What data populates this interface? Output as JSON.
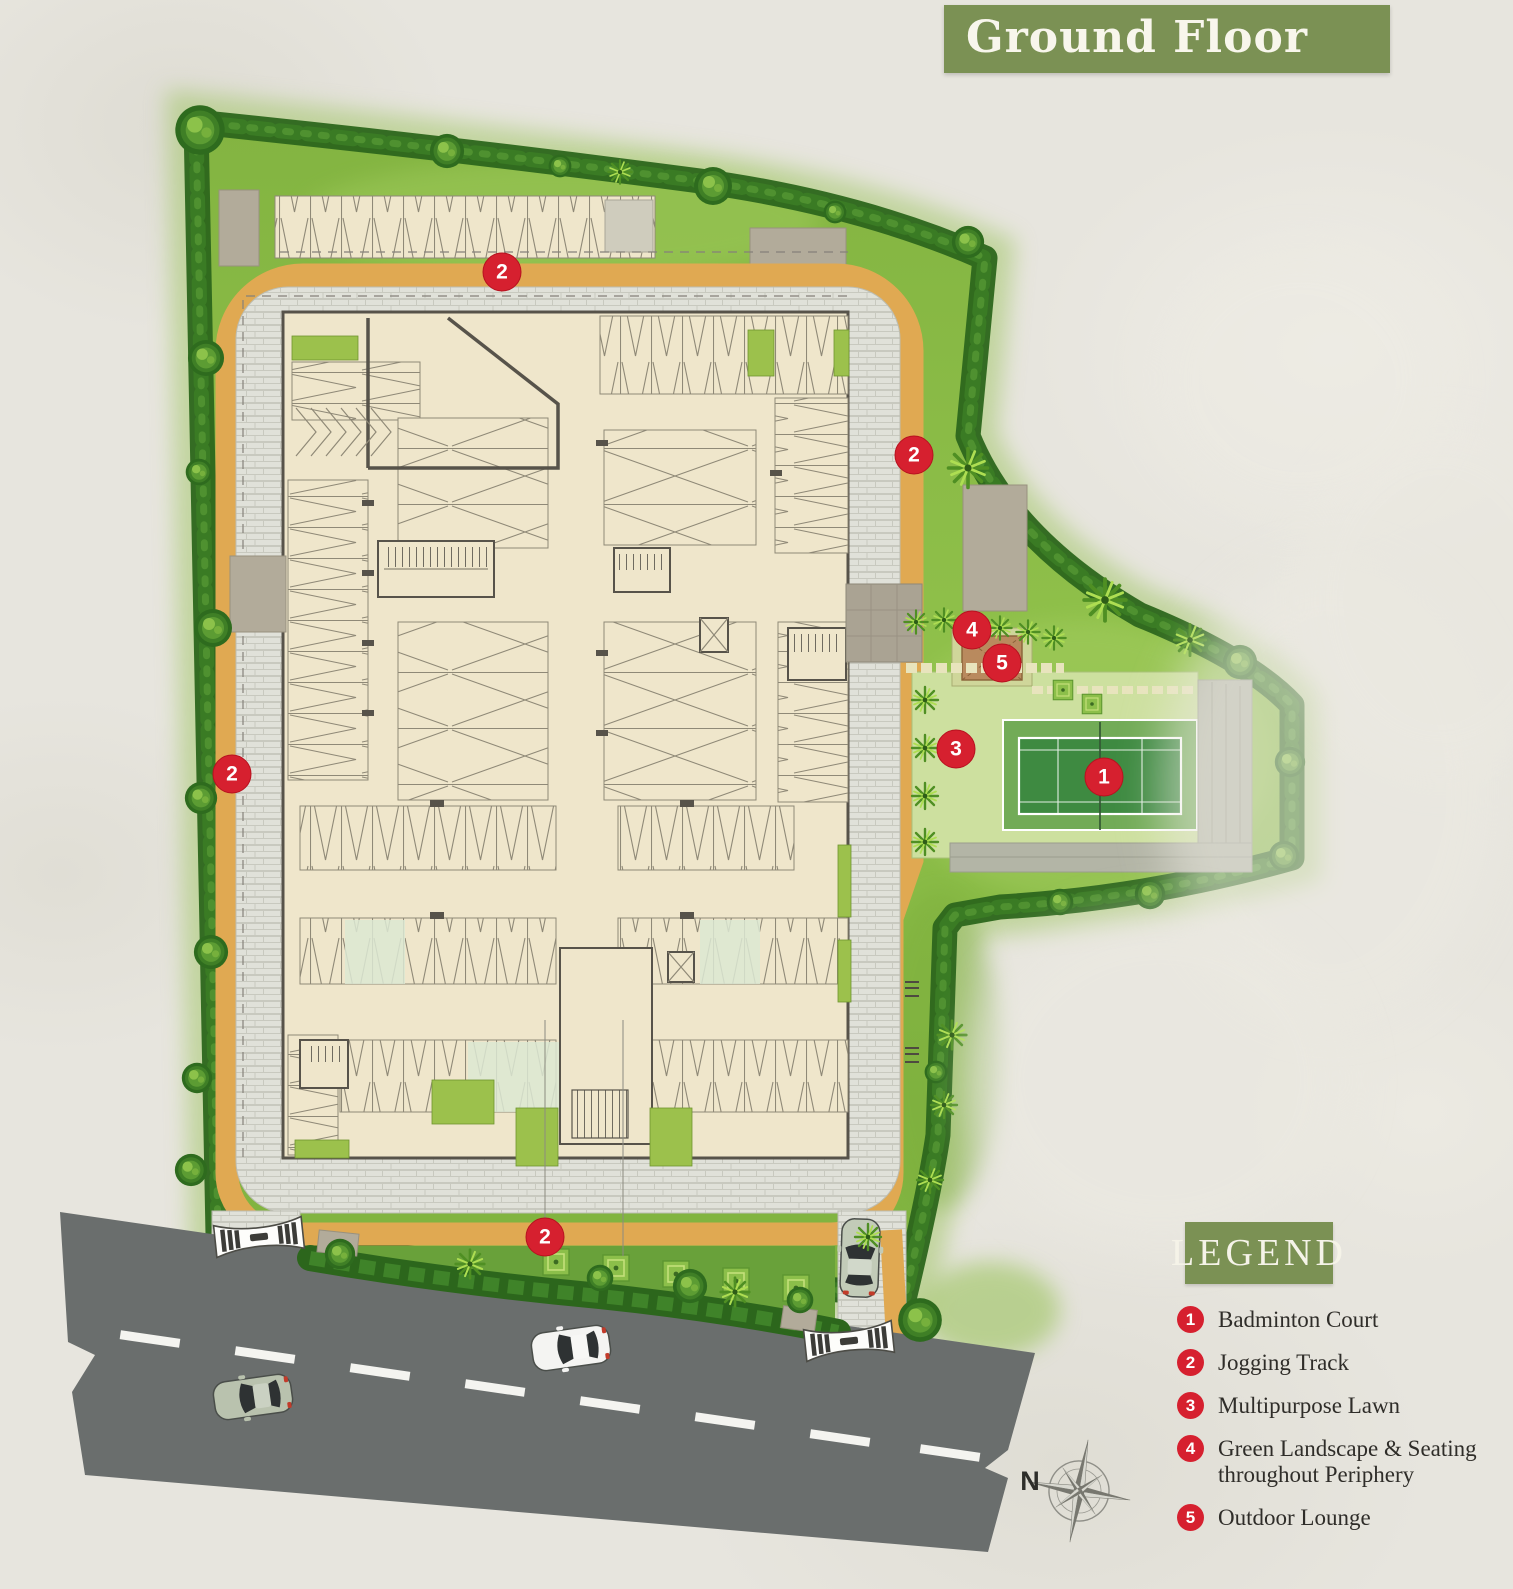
{
  "title_badge": {
    "text": "Ground Floor"
  },
  "legend": {
    "heading": "LEGEND",
    "items": [
      {
        "number": "1",
        "label": "Badminton Court"
      },
      {
        "number": "2",
        "label": "Jogging Track"
      },
      {
        "number": "3",
        "label": "Multipurpose Lawn"
      },
      {
        "number": "4",
        "label": "Green Landscape & Seating throughout Periphery"
      },
      {
        "number": "5",
        "label": "Outdoor Lounge"
      }
    ]
  },
  "map_markers": [
    {
      "label": "2"
    },
    {
      "label": "2"
    },
    {
      "label": "2"
    },
    {
      "label": "2"
    },
    {
      "label": "4"
    },
    {
      "label": "5"
    },
    {
      "label": "3"
    },
    {
      "label": "1"
    }
  ],
  "compass": {
    "north_label": "N"
  },
  "colors": {
    "badge_green": "#7b9154",
    "marker_red": "#d6202f",
    "track_tan": "#e0a952",
    "court_green": "#3e8a41",
    "road_grey": "#6a6e6d"
  }
}
